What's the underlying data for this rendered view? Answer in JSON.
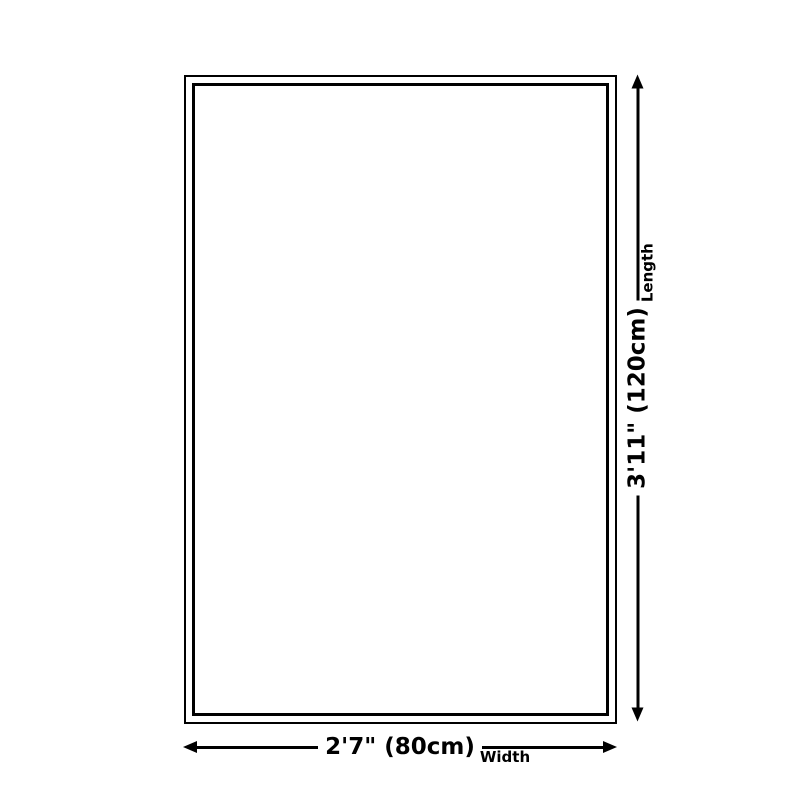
{
  "page": {
    "background_color": "#ffffff",
    "line_color": "#000000",
    "text_color": "#000000"
  },
  "diagram": {
    "type": "product-size-diagram",
    "dimensions": {
      "width": {
        "value": "2'7\" (80cm)",
        "label": "Width"
      },
      "length": {
        "value": "3'11\" (120cm)",
        "label": "Length"
      }
    },
    "icons": {
      "arrow_left": "left-filled-triangle-arrowhead",
      "arrow_right": "right-filled-triangle-arrowhead",
      "arrow_up": "up-filled-triangle-arrowhead",
      "arrow_down": "down-filled-triangle-arrowhead"
    }
  }
}
